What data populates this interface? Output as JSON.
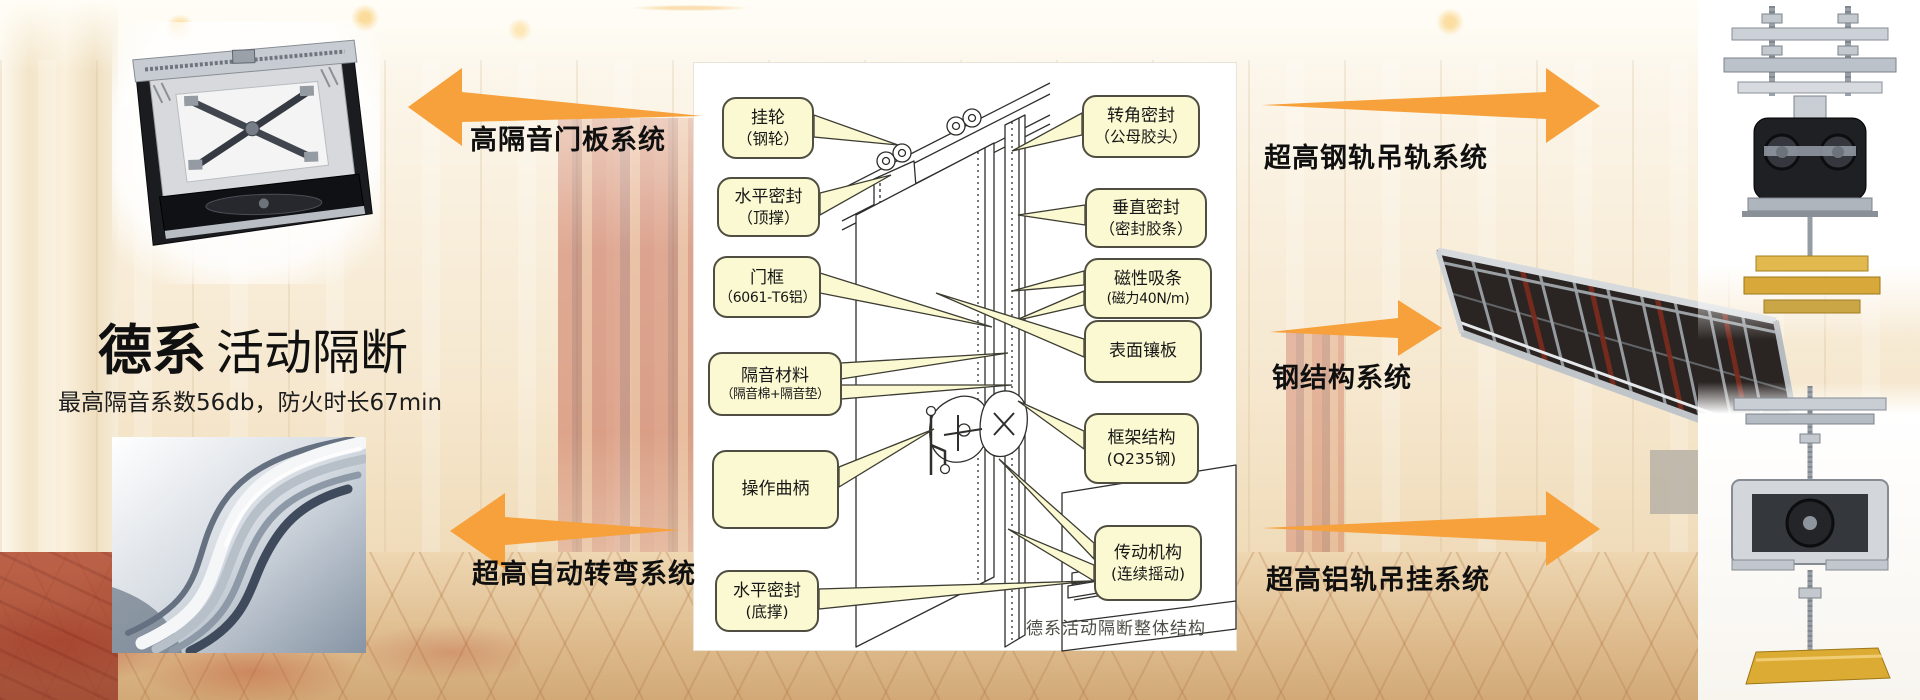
{
  "brand": {
    "title_bold": "德系",
    "title_rest": "活动隔断",
    "subtitle": "最高隔音系数56db，防火时长67min"
  },
  "systems": {
    "door_panel": "高隔音门板系统",
    "steel_rail": "超高钢轨吊轨系统",
    "steel_structure": "钢结构系统",
    "auto_turn": "超高自动转弯系统",
    "aluminum_rail": "超高铝轨吊挂系统"
  },
  "diagram": {
    "caption": "德系活动隔断整体结构",
    "callouts_left": [
      {
        "line1": "挂轮",
        "line2": "（钢轮）"
      },
      {
        "line1": "水平密封",
        "line2": "（顶撑）"
      },
      {
        "line1": "门框",
        "line2": "（6061-T6铝）"
      },
      {
        "line1": "隔音材料",
        "line2": "（隔音棉+隔音垫）"
      },
      {
        "line1": "操作曲柄",
        "line2": ""
      },
      {
        "line1": "水平密封",
        "line2": "(底撑)"
      }
    ],
    "callouts_right": [
      {
        "line1": "转角密封",
        "line2": "（公母胶头）"
      },
      {
        "line1": "垂直密封",
        "line2": "（密封胶条）"
      },
      {
        "line1": "磁性吸条",
        "line2": "(磁力40N/m)"
      },
      {
        "line1": "表面镶板",
        "line2": ""
      },
      {
        "line1": "框架结构",
        "line2": "(Q235钢)"
      },
      {
        "line1": "传动机构",
        "line2": "(连续摇动)"
      }
    ]
  },
  "colors": {
    "accent_orange": "#F6A13B",
    "callout_bg": "#FBF9D2",
    "callout_border": "#4F4E40"
  }
}
